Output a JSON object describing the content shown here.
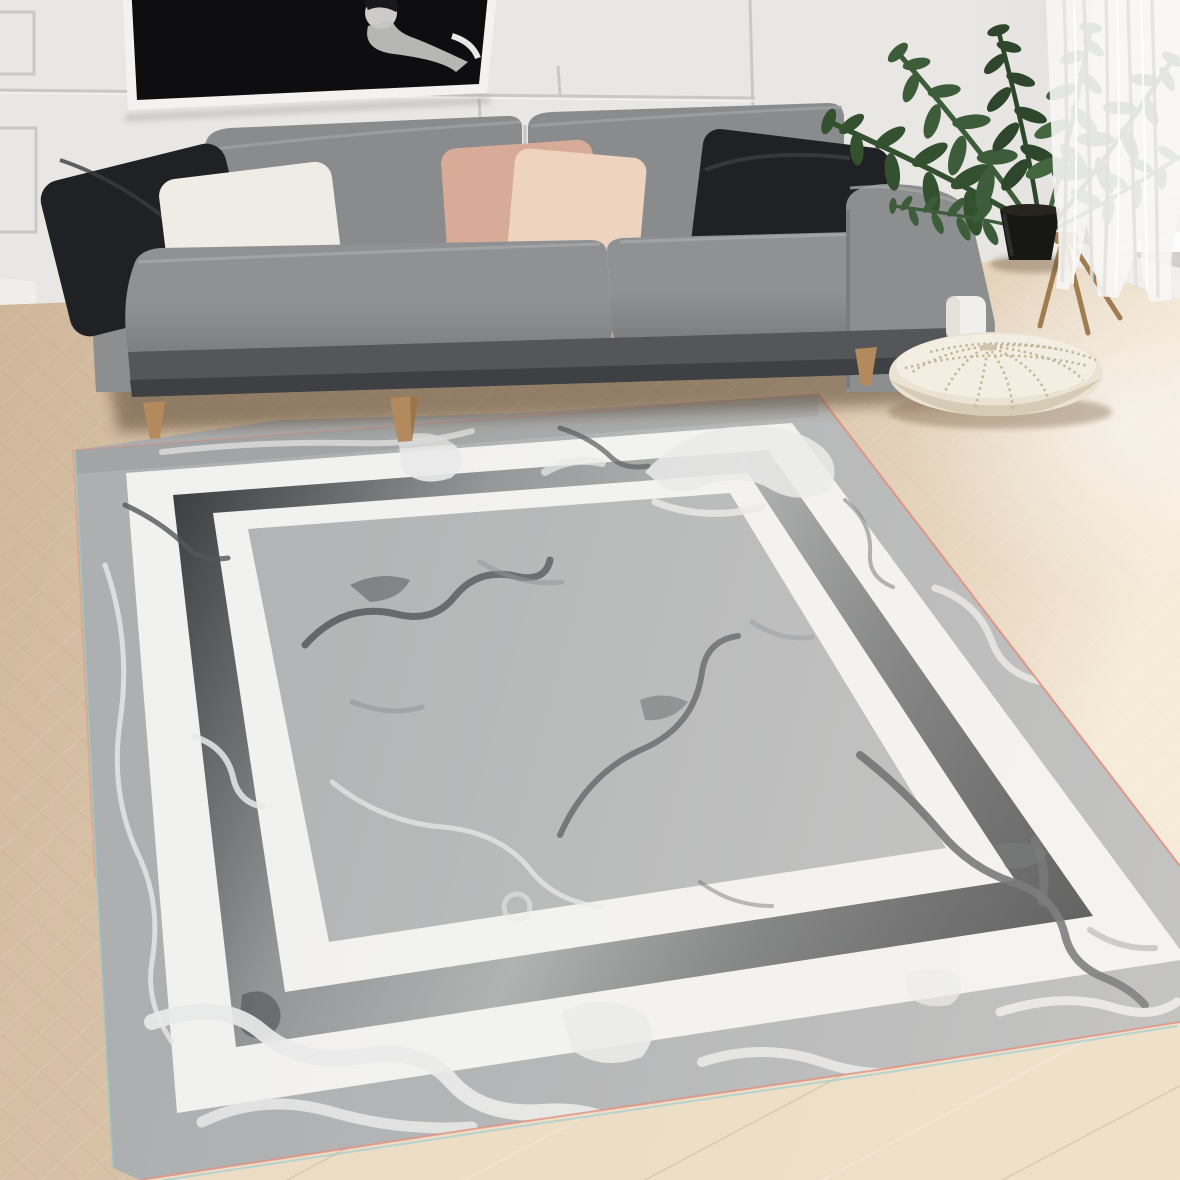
{
  "meta": {
    "description": "Living room product photo: gray marble-patterned area rug with double white frame border, gray sofa with throw pillows, black-and-white wall art, potted plant, knitted pouf, sheer curtain, herringbone oak floor",
    "width": 1180,
    "height": 1180
  },
  "palette": {
    "wall": "#e9e7e4",
    "trim": "#cbc8c4",
    "baseboard": "#efeeeb",
    "art_frame": "#f3f2ef",
    "art_canvas": "#0e0e10",
    "art_figure": "#cccbc9",
    "window_light": "#fcfcfb",
    "curtain": "#f7f6f4",
    "floor": "#d9c3a8",
    "floor_light": "#eedfc8",
    "sofa_back": "#898b8d",
    "sofa_seat": "#8f9193",
    "sofa_arm": "#8c8e90",
    "sofa_base": "#54565a",
    "leg_wood": "#b28a5e",
    "pillow_black": "#1f2124",
    "pillow_white": "#eeece5",
    "pillow_blush": "#d8ab99",
    "pillow_blush_light": "#eed3bf",
    "rug_field": "#b2b4b5",
    "rug_margin": "#adafb1",
    "rug_white_band": "#f1f1ef",
    "rug_vein_dark": "#54565a",
    "rug_vein_mid": "#8e9093",
    "rug_vein_light": "#e8e9e9",
    "rug_edge_pink": "#e08d7e",
    "rug_edge_cyan": "#8fcbd1",
    "pouf": "#eae3d3",
    "pouf_knit": "#c0b59c",
    "plant_dark": "#2e462c",
    "plant_mid": "#3d5c39",
    "plant_light": "#4d7046",
    "pot": "#171715"
  },
  "objects": {
    "rug": {
      "name": "marble pattern area rug",
      "border": "double white bands with gradient charcoal band"
    },
    "sofa": {
      "name": "gray fabric sofa",
      "pillows": [
        "black",
        "white",
        "blush",
        "light blush",
        "black"
      ],
      "legs": "tapered wood"
    },
    "wall_art": {
      "name": "black and white framed artwork"
    },
    "plant": {
      "name": "potted houseplant in black planter"
    },
    "pouf": {
      "name": "cream knitted pouf"
    },
    "curtain": {
      "name": "white sheer curtain"
    },
    "floor": {
      "name": "light oak herringbone parquet"
    },
    "wall": {
      "name": "paneled wall with chair rail"
    }
  }
}
